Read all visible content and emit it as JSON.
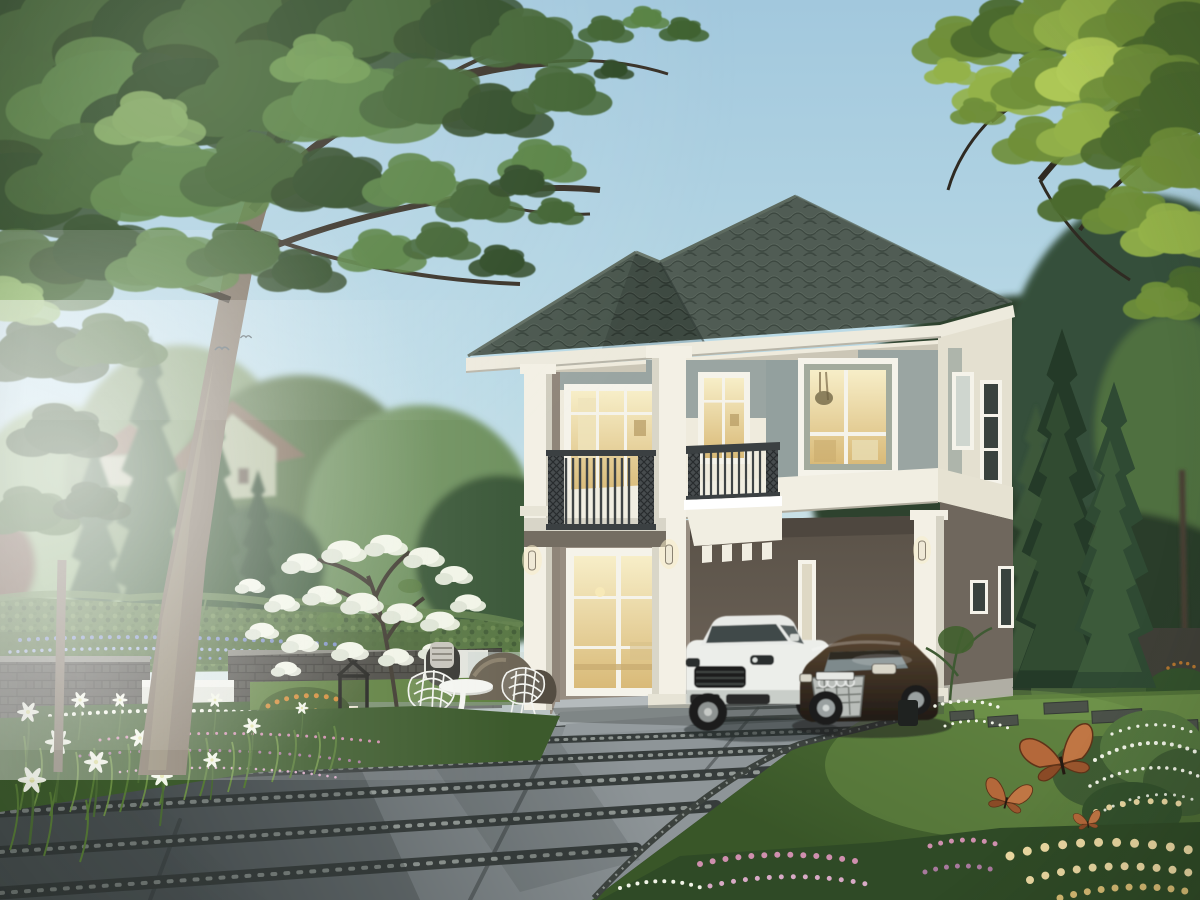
{
  "scene": {
    "kind": "photorealistic exterior rendering",
    "subject": "modern two-story house with carport, garden and driveway",
    "objects": [
      "sky",
      "large shade tree",
      "overhanging branches",
      "background trees",
      "neighboring house roof",
      "garden hedge",
      "brick garden wall",
      "lavender border",
      "white flower bed",
      "flowering white tree",
      "orange shrub",
      "candle lantern",
      "white wire chairs",
      "white pedestal table",
      "garden rocks",
      "two-story house",
      "hip roof with dark tiles",
      "balcony with dark railing",
      "juliet balcony planter",
      "warm lit windows",
      "sliding glass door",
      "entry steps",
      "wall sconces",
      "carport",
      "white suv",
      "dark bronze coupe",
      "stone slab driveway",
      "gravel joints",
      "lawn",
      "stepping stones",
      "rose bushes",
      "white flower bush",
      "butterflies",
      "tall cypress trees",
      "birds",
      "sunlight haze"
    ]
  },
  "palette": {
    "sky-top": "#a2c8dd",
    "sky-mid": "#badae6",
    "sky-low": "#dce8e6",
    "foliage-dark": "#2c4724",
    "foliage-mid": "#3e612f",
    "foliage-light": "#558040",
    "foliage-bright": "#6f9c50",
    "foliage-accent": "#8ab364",
    "yellow-dark": "#4c6a2e",
    "yellow-mid": "#6f8f3a",
    "yellow-light": "#94b24a",
    "yellow-bright": "#b2cc5a",
    "conifer-dark": "#243a28",
    "conifer-mid": "#2f4a33",
    "conifer-light": "#3c5a38",
    "branch": "#352e24",
    "trunk": "#7c7060",
    "trunk-light": "#93886f",
    "bg-tree": "#577347",
    "bg-tree-dark": "#3d5a3a",
    "bg-haze-tree": "#8fae7d",
    "roof-tile": "#47544b",
    "roof-tile-dark": "#333f37",
    "roof-tile-light": "#5d6a5f",
    "fascia": "#edeadd",
    "wall-cream": "#efebdd",
    "wall-cream-shade": "#c6c2b1",
    "wall-side": "#e4e0d0",
    "panel-sage": "#9aa5a2",
    "band-white": "#f1eee2",
    "column-white": "#f3f0e5",
    "railing": "#3b4042",
    "window-frame": "#f5f3ea",
    "glass-warm-hi": "#f7eec8",
    "glass-warm-lo": "#d9ba78",
    "glass-pale": "#cfd6cf",
    "glass-dark": "#39423e",
    "wall-taupe": "#978d81",
    "wall-taupe-dark": "#7e7468",
    "wall-side-lower": "#6f675d",
    "carport-dark": "#5a5248",
    "carport-mid": "#6e6459",
    "step-concrete": "#b5bbbd",
    "drive-light": "#8e9598",
    "drive-dark": "#4f5658",
    "joint-dark": "#363c3b",
    "gravel-speck": "#aab0ac",
    "lawn-light": "#6e9148",
    "lawn-mid": "#527238",
    "lawn-dark": "#395628",
    "hedge-green": "#5a7846",
    "hedge-dark": "#46603a",
    "brick": "#4c4b45",
    "brick-dark": "#3a3934",
    "planter-white": "#e3e5dd",
    "flower-blue": "#7d90c4",
    "flower-blue-light": "#9fb1da",
    "flower-white": "#f2f5e8",
    "flower-pink": "#cf8fae",
    "flower-pink-dark": "#a8799d",
    "flower-pink-light": "#d8aac6",
    "flower-orange": "#d28a35",
    "rose-cream": "#ecd9a2",
    "butterfly-orange": "#b4683a",
    "butterfly-dark": "#5f3318",
    "car-white": "#eceeea",
    "car-white-shade": "#c9cec9",
    "car-dark": "#2f2721",
    "car-bronze": "#6b543c",
    "chrome": "#c3c7c3",
    "tire": "#1b1c1b",
    "rock": "#6e6657",
    "rock-dark": "#544d42",
    "lantern": "#23231f",
    "furniture-white": "#f4f5f1",
    "shadow": "#2c3433"
  }
}
